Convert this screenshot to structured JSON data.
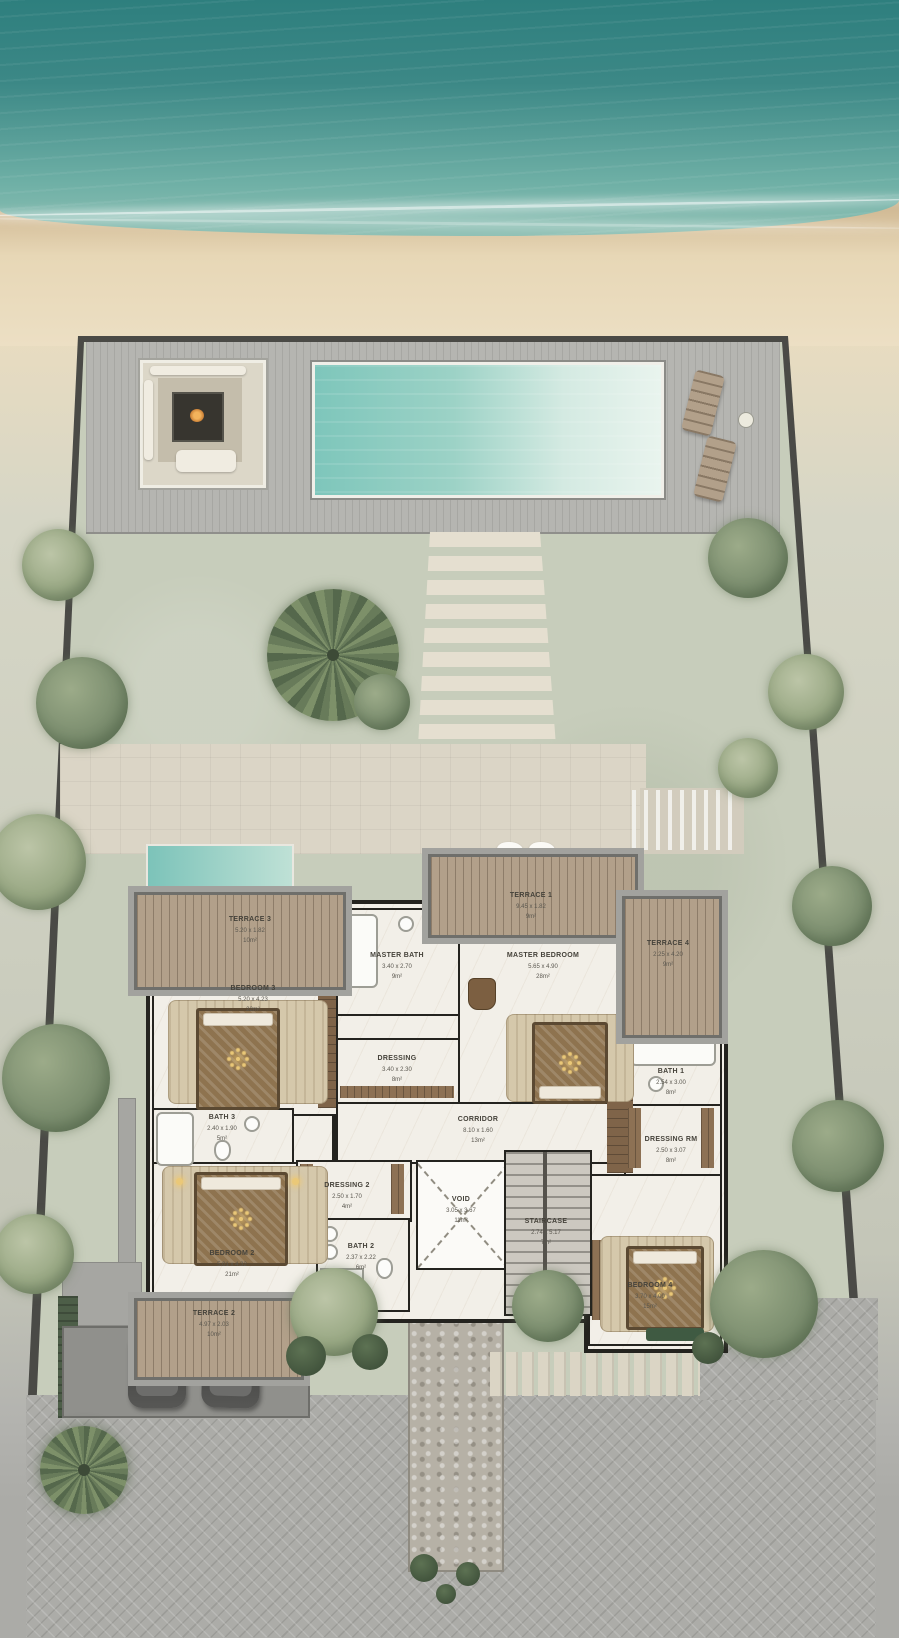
{
  "palette": {
    "sea_deep": "#2e7f7e",
    "sea_light": "#6fb0a6",
    "sand": "#e7d7b6",
    "garden": "#c7cdbb",
    "deck": "#b5b5b1",
    "pool_left": "#7ec6bb",
    "wood": "#b2a08a",
    "wall": "#24231f",
    "marble": "#f2efe8",
    "pavement": "#acaca8",
    "label_ink": "#45423a",
    "glow": "#eac878"
  },
  "rooms": [
    {
      "name": "TERRACE 3",
      "dims": "5.20 x 1.82",
      "area": "10m²"
    },
    {
      "name": "BEDROOM 3",
      "dims": "5.20 x 4.23",
      "area": "22m²"
    },
    {
      "name": "MASTER BATH",
      "dims": "3.40 x 2.70",
      "area": "9m²"
    },
    {
      "name": "TERRACE 1",
      "dims": "9.45 x 1.82",
      "area": "9m²"
    },
    {
      "name": "MASTER BEDROOM",
      "dims": "5.65 x 4.90",
      "area": "28m²"
    },
    {
      "name": "TERRACE 4",
      "dims": "2.25 x 4.20",
      "area": "9m²"
    },
    {
      "name": "DRESSING",
      "dims": "3.40 x 2.30",
      "area": "8m²"
    },
    {
      "name": "BATH 1",
      "dims": "2.54 x 3.00",
      "area": "8m²"
    },
    {
      "name": "CORRIDOR",
      "dims": "8.10 x 1.60",
      "area": "13m²"
    },
    {
      "name": "DRESSING RM",
      "dims": "2.50 x 3.07",
      "area": "8m²"
    },
    {
      "name": "BATH 3",
      "dims": "2.40 x 1.90",
      "area": "5m²"
    },
    {
      "name": "BEDROOM 2",
      "dims": "5.01 x 4.32",
      "area": "21m²"
    },
    {
      "name": "DRESSING 2",
      "dims": "2.50 x 1.70",
      "area": "4m²"
    },
    {
      "name": "BATH 2",
      "dims": "2.37 x 2.22",
      "area": "6m²"
    },
    {
      "name": "VOID",
      "dims": "3.05 x 3.67",
      "area": "11m²"
    },
    {
      "name": "STAIRCASE",
      "dims": "2.74 x 5.17",
      "area": "7m²"
    },
    {
      "name": "BEDROOM 4",
      "dims": "3.70 x 4.09",
      "area": "15m²"
    },
    {
      "name": "TERRACE 2",
      "dims": "4.97 x 2.03",
      "area": "10m²"
    }
  ]
}
